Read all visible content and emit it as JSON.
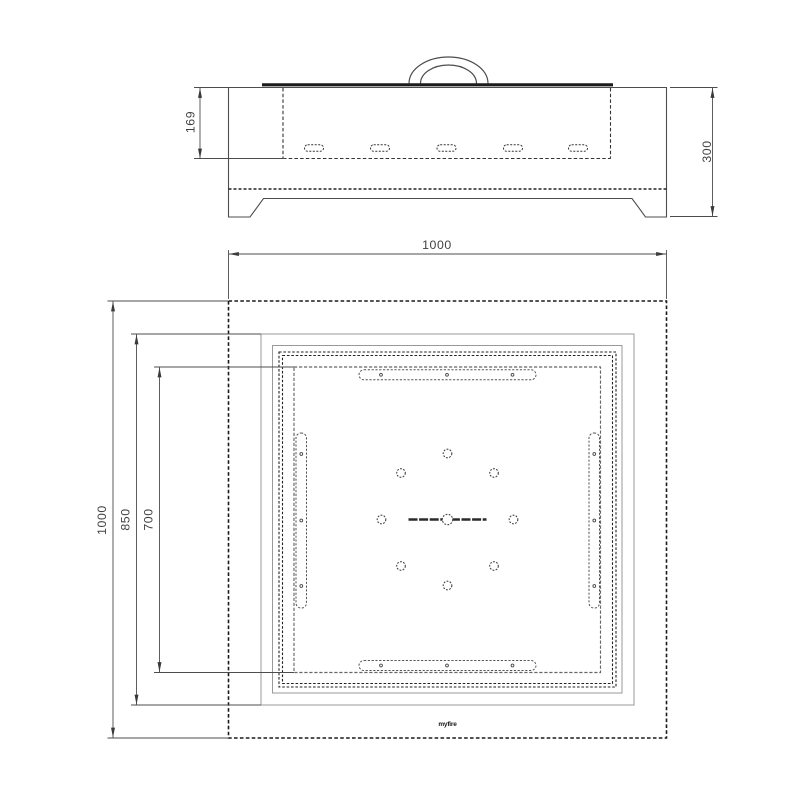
{
  "drawing": {
    "side_view": {
      "dim_bowl_depth": "169",
      "dim_total_height": "300"
    },
    "plan_view": {
      "dim_outer_width": "1000",
      "dim_outer_height": "1000",
      "dim_tabletop_inner": "850",
      "dim_bowl_opening": "700",
      "brand_logo": "myfire"
    },
    "colors": {
      "line_dark": "#1a1a1a",
      "line_medium": "#4d4d4d",
      "line_light": "#9a9a9a",
      "dim_text": "#414141",
      "background": "#ffffff"
    }
  }
}
